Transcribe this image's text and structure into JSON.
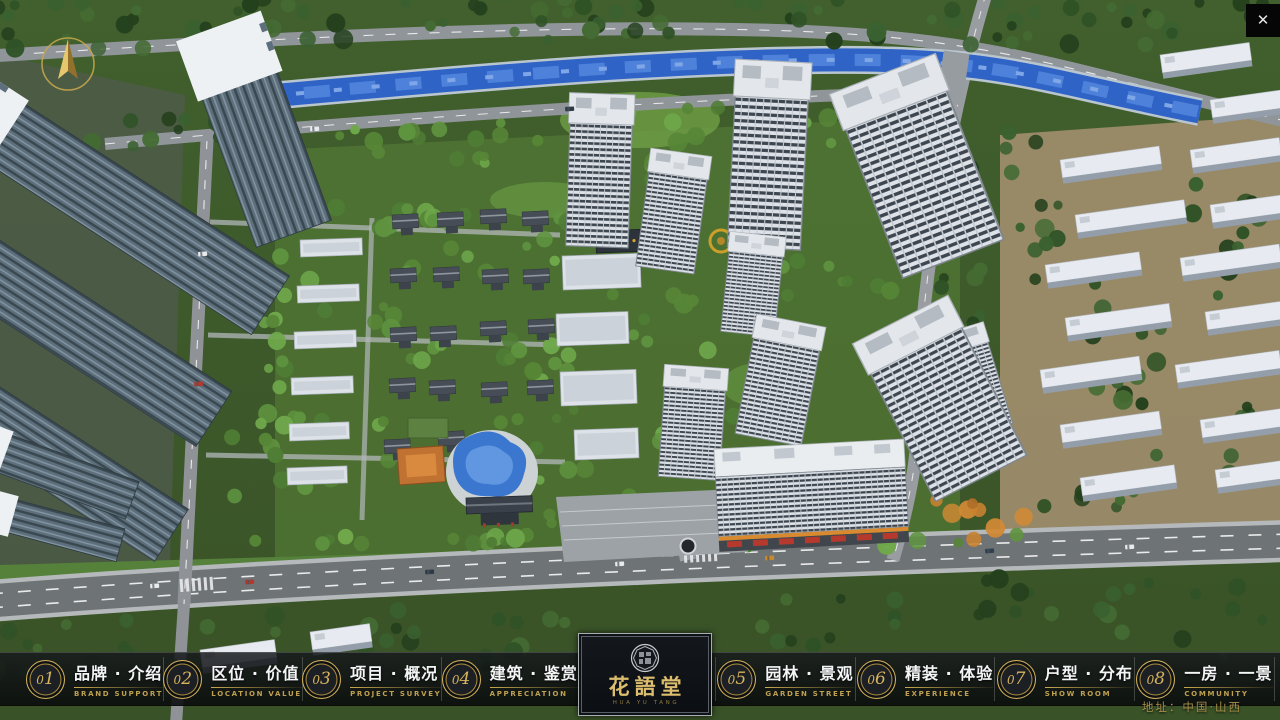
{
  "ui": {
    "close_icon": "✕",
    "address": "地址：中国·山西"
  },
  "logo": {
    "title": "花語堂",
    "subtitle": "HUA YU TANG"
  },
  "nav": {
    "items": [
      {
        "num": "01",
        "zh": "品牌 · 介绍",
        "en": "BRAND SUPPORT"
      },
      {
        "num": "02",
        "zh": "区位 · 价值",
        "en": "LOCATION VALUE"
      },
      {
        "num": "03",
        "zh": "项目 · 概况",
        "en": "PROJECT SURVEY"
      },
      {
        "num": "04",
        "zh": "建筑 · 鉴赏",
        "en": "APPRECIATION"
      },
      {
        "num": "05",
        "zh": "园林 · 景观",
        "en": "GARDEN STREET"
      },
      {
        "num": "06",
        "zh": "精装 · 体验",
        "en": "EXPERIENCE"
      },
      {
        "num": "07",
        "zh": "户型 · 分布",
        "en": "SHOW ROOM"
      },
      {
        "num": "08",
        "zh": "一房 · 一景",
        "en": "COMMUNITY"
      }
    ]
  },
  "colors": {
    "accent_gold": "#c9a84c",
    "bar_bg": "#0a0c0e",
    "river_blue": "#2f63c6"
  }
}
